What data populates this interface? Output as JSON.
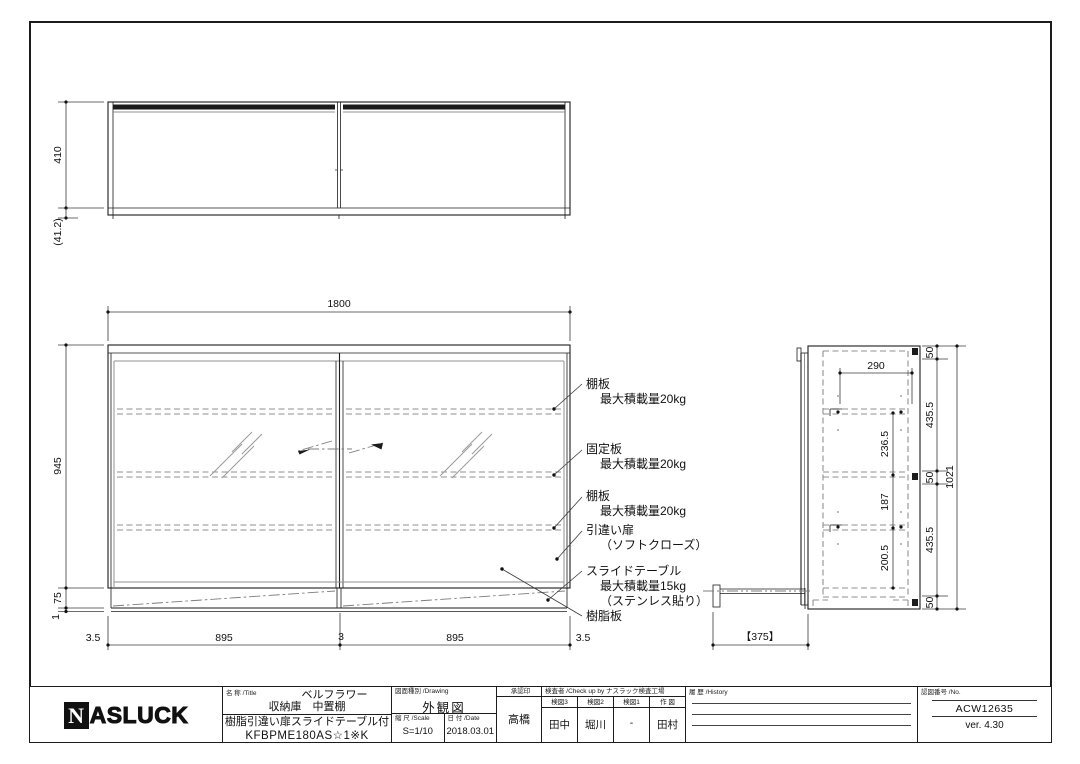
{
  "title_block": {
    "logo_n": "N",
    "logo_rest": "ASLUCK",
    "name_label": "名 称 /Title",
    "product_line1": "ベルフラワー",
    "product_line2": "収納庫　中置棚",
    "product_line3": "樹脂引違い扉スライドテーブル付",
    "product_code": "KFBPME180AS☆1※K",
    "drawing_type_label": "図面種別 /Drawing",
    "drawing_type": "外観図",
    "scale_label": "縮 尺 /Scale",
    "scale": "S=1/10",
    "date_label": "日 付 /Date",
    "date": "2018.03.01",
    "approval_label": "承認印",
    "approval": "高橋",
    "checkers_label": "検査者 /Check up by ナスラック検査工場",
    "checkers": [
      {
        "role": "検図3",
        "name": "田中"
      },
      {
        "role": "検図2",
        "name": "堀川"
      },
      {
        "role": "検図1",
        "name": "-"
      },
      {
        "role": "作 図",
        "name": "田村"
      }
    ],
    "history_label": "履 歴 /History",
    "number_label": "認図番号 /No.",
    "number": "ACW12635",
    "version": "ver. 4.30"
  },
  "top_view": {
    "dim_depth": "410",
    "dim_offset": "(41.2)"
  },
  "front_view": {
    "dim_width": "1800",
    "dim_height": "945",
    "dim_base": "75",
    "dim_edge": "1",
    "bottom": [
      "3.5",
      "895",
      "3",
      "895",
      "3.5"
    ],
    "ann": [
      {
        "l1": "棚板",
        "l2": "最大積載量20kg"
      },
      {
        "l1": "固定板",
        "l2": "最大積載量20kg"
      },
      {
        "l1": "棚板",
        "l2": "最大積載量20kg"
      },
      {
        "l1": "引違い扉",
        "l2": "（ソフトクローズ）"
      },
      {
        "l1": "スライドテーブル",
        "l2": "最大積載量15kg",
        "l3": "（ステンレス貼り）"
      },
      {
        "l1": "樹脂板"
      }
    ]
  },
  "side_view": {
    "dim_shelf": "290",
    "p1": "236.5",
    "p2": "187",
    "p3": "200.5",
    "r1": "50",
    "r2": "435.5",
    "r3": "50",
    "r4": "435.5",
    "r5": "50",
    "overall": "1021",
    "table": "【375】"
  }
}
